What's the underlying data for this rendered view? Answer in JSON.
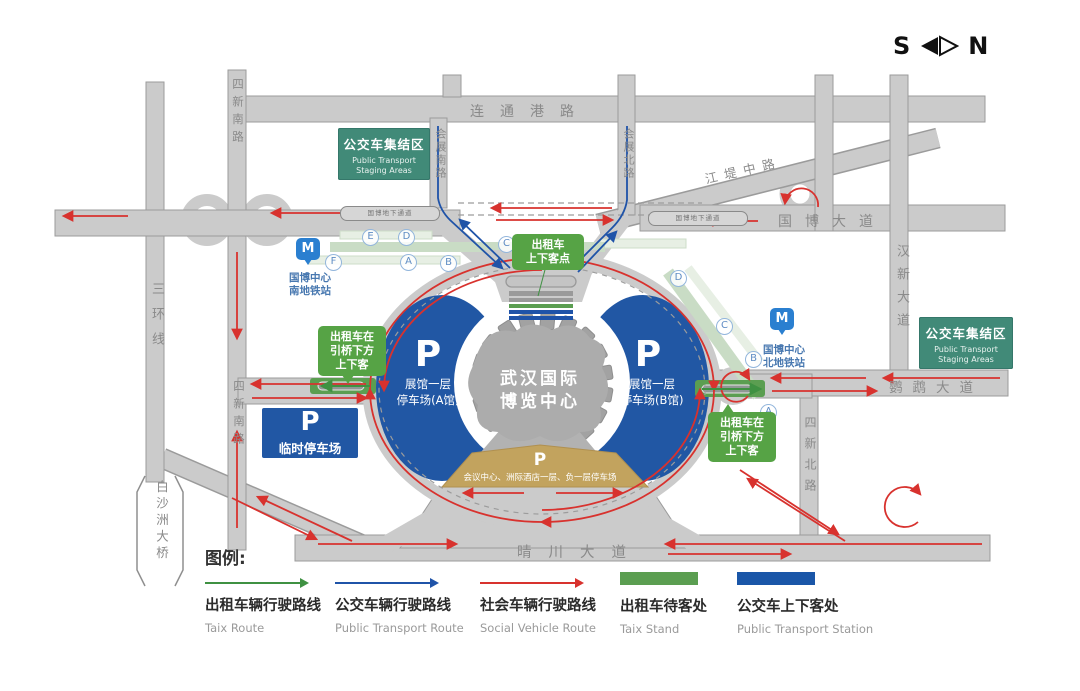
{
  "compass": {
    "south": "S",
    "north": "N"
  },
  "roads": {
    "liantonggang_road": "连通港路",
    "huizhan_south_road": "会展南路",
    "huizhan_north_road": "会展北路",
    "jiangdi_middle_road": "江堤中路",
    "guobo_avenue": "国博大道",
    "guobo_underpass": "国博地下通道",
    "hanxin_avenue": "汉新大道",
    "yingwu_avenue": "鹦鹉大道",
    "third_ring_road": "三环线",
    "sixin_south_road": "四新南路",
    "sixin_north_road": "四新北路",
    "qingchuan_avenue": "晴川大道",
    "baishazhou_bridge": "白沙洲大桥"
  },
  "staging_area": {
    "title": "公交车集结区",
    "subtitle": "Public Transport Staging Areas"
  },
  "metro": {
    "icon": "M",
    "south": {
      "line1": "国博中心",
      "line2": "南地铁站",
      "exits": [
        "E",
        "D",
        "F",
        "A",
        "B",
        "C"
      ]
    },
    "north": {
      "line1": "国博中心",
      "line2": "北地铁站",
      "exits": [
        "D",
        "C",
        "B",
        "A"
      ]
    }
  },
  "callouts": {
    "taxi_point": {
      "line1": "出租车",
      "line2": "上下客点"
    },
    "taxi_bridge": {
      "line1": "出租车在",
      "line2": "引桥下方",
      "line3": "上下客"
    }
  },
  "center_building": {
    "line1": "武汉国际",
    "line2": "博览中心"
  },
  "parking": {
    "p": "P",
    "hall_a": {
      "line1": "展馆一层",
      "line2": "停车场(A馆)"
    },
    "hall_b": {
      "line1": "展馆一层",
      "line2": "停车场(B馆)"
    },
    "temporary": "临时停车场",
    "basement": "会议中心、洲际酒店一层、负一层停车场"
  },
  "legend": {
    "title": "图例:",
    "items": [
      {
        "type": "arrow",
        "color": "#3f9142",
        "zh": "出租车辆行驶路线",
        "en": "Taix Route"
      },
      {
        "type": "arrow",
        "color": "#1f53a8",
        "zh": "公交车辆行驶路线",
        "en": "Public Transport Route"
      },
      {
        "type": "arrow",
        "color": "#d8322e",
        "zh": "社会车辆行驶路线",
        "en": "Social Vehicle Route"
      },
      {
        "type": "swatch",
        "color": "#5b9e51",
        "zh": "出租车待客处",
        "en": "Taix Stand"
      },
      {
        "type": "swatch",
        "color": "#1a56a8",
        "zh": "公交车上下客处",
        "en": "Public Transport Station"
      }
    ]
  },
  "colors": {
    "road": "#cbcbcb",
    "taxi_route": "#3f9142",
    "bus_route": "#1f53a8",
    "social_route": "#d8322e",
    "parking_blue": "#2157a4",
    "staging_green": "#418a78",
    "callout_green": "#56a345",
    "basement_tan": "#c2a35e",
    "metro_strip": "#c9dcc5"
  }
}
